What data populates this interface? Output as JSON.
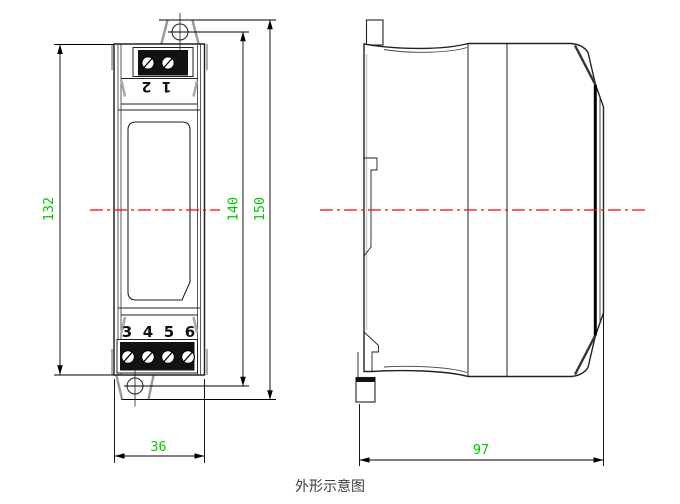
{
  "caption": "外形示意图",
  "colors": {
    "dimension": "#00c800",
    "centerline": "#ff0000",
    "line": "#1a1a1a",
    "caption": "#3c3c3c"
  },
  "front_view": {
    "top_terminal_labels": [
      "1",
      "2"
    ],
    "bottom_terminal_labels": [
      "3",
      "4",
      "5",
      "6"
    ]
  },
  "dimensions": {
    "body_height": "132",
    "mounting_height": "140",
    "overall_height": "150",
    "width": "36",
    "depth": "97"
  }
}
